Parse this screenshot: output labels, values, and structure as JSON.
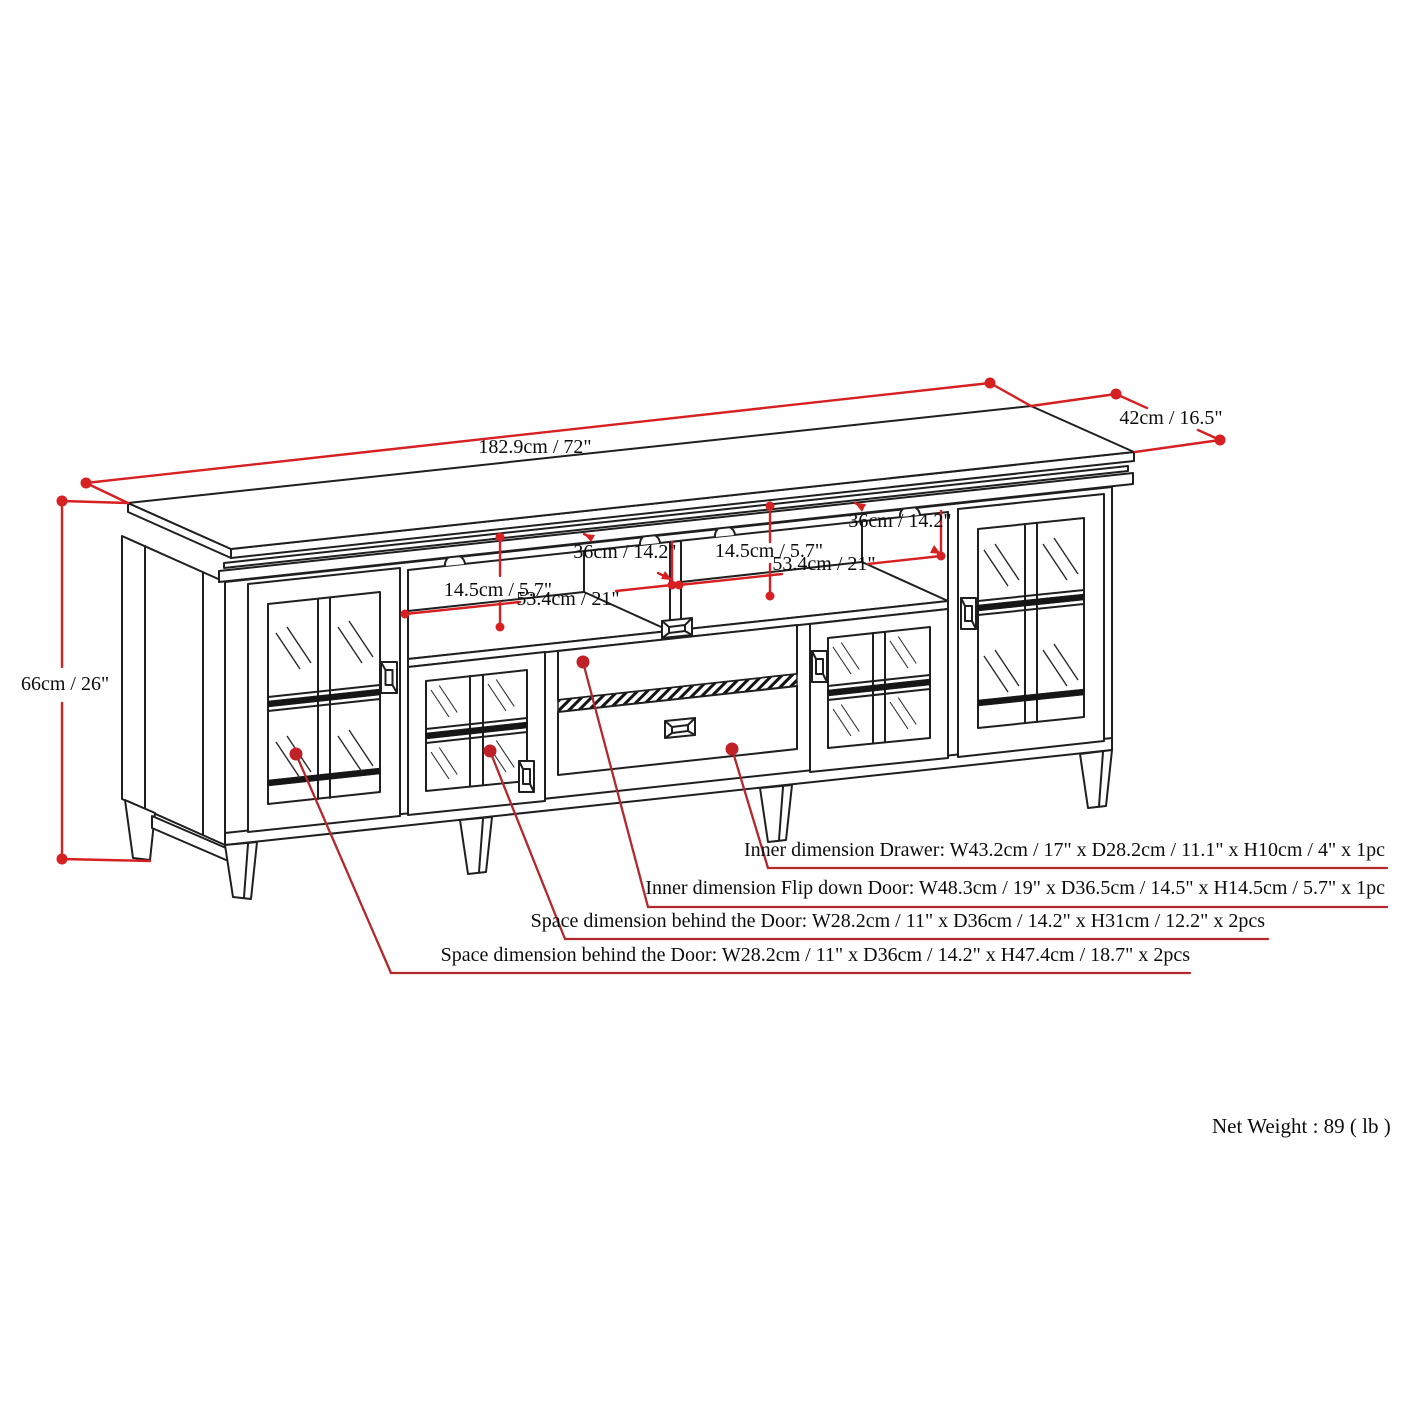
{
  "colors": {
    "dimension_line_red": "#d62021",
    "leader_line_red": "#b3282c",
    "drawing_line_black": "#1f1f1f"
  },
  "overall_dimensions": {
    "width": "182.9cm / 72\"",
    "depth": "42cm / 16.5\"",
    "height": "66cm / 26\""
  },
  "shelf_left": {
    "height": "14.5cm / 5.7\"",
    "width": "53.4cm / 21\"",
    "depth": "36cm / 14.2\""
  },
  "shelf_right": {
    "height": "14.5cm / 5.7\"",
    "width": "53.4cm / 21\"",
    "depth": "36cm / 14.2\""
  },
  "callouts": {
    "drawer": "Inner dimension Drawer: W43.2cm / 17\" x D28.2cm / 11.1\" x H10cm / 4\" x 1pc",
    "flip_down_door": "Inner dimension Flip down Door: W48.3cm / 19\" x D36.5cm / 14.5\" x H14.5cm / 5.7\" x 1pc",
    "door_center": "Space dimension behind the Door: W28.2cm / 11\" x D36cm / 14.2\" x H31cm / 12.2\" x 2pcs",
    "door_side": "Space dimension behind the Door:  W28.2cm / 11\" x D36cm / 14.2\" x H47.4cm / 18.7\" x 2pcs"
  },
  "net_weight": "Net Weight : 89 ( lb )"
}
